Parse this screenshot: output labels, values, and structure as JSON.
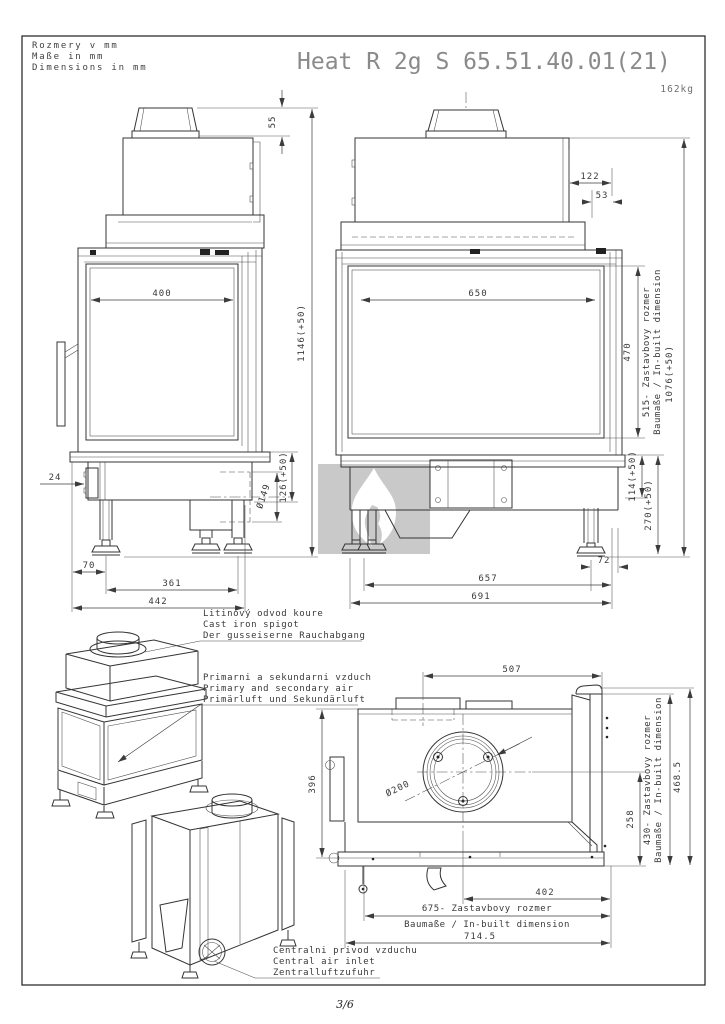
{
  "meta": {
    "units": [
      "Rozmery v mm",
      "Maße in mm",
      "Dimensions in mm"
    ],
    "title": "Heat R 2g S 65.51.40.01(21)",
    "weight": "162kg",
    "page": "3/6"
  },
  "side_view": {
    "collar_height": "55",
    "glass_width": "400",
    "total_height": "1146(+50)",
    "base_height": "126(+50)",
    "flue_diameter": "Ø149",
    "handle_offset": "24",
    "foot_offset": "70",
    "feet_span": "361",
    "overall_width": "442"
  },
  "front_view": {
    "top_offset": "122",
    "collar_offset": "53",
    "glass_width": "650",
    "glass_height": "470",
    "inbuilt_line1": "515- Zastavbovy rozmer",
    "inbuilt_line2": "Baumaße / In-built dimension",
    "overall_height": "1076(+50)",
    "base_height1": "114(+50)",
    "base_height2": "270(+50)",
    "foot_offset": "72",
    "feet_span": "657",
    "overall_width": "691"
  },
  "plan_view": {
    "collar_offset": "507",
    "depth": "396",
    "flue_diameter": "Ø200",
    "rear_depth": "258",
    "inbuilt_depth1": "430- Zastavbovy rozmer",
    "inbuilt_depth2": "Baumaße / In-built dimension",
    "overall_depth": "468.5",
    "center_to_right": "402",
    "inbuilt_width1": "675- Zastavbovy rozmer",
    "inbuilt_width2": "Baumaße / In-built dimension",
    "overall_width": "714.5"
  },
  "annotations": {
    "spigot": [
      "Litinový odvod koure",
      "Cast iron spigot",
      "Der gusseiserne Rauchabgang"
    ],
    "air": [
      "Primarni a sekundarni vzduch",
      "Primary and secondary air",
      "Primärluft und Sekundärluft"
    ],
    "central_air": [
      "Centralni privod vzduchu",
      "Central air inlet",
      "Zentralluftzufuhr"
    ]
  }
}
